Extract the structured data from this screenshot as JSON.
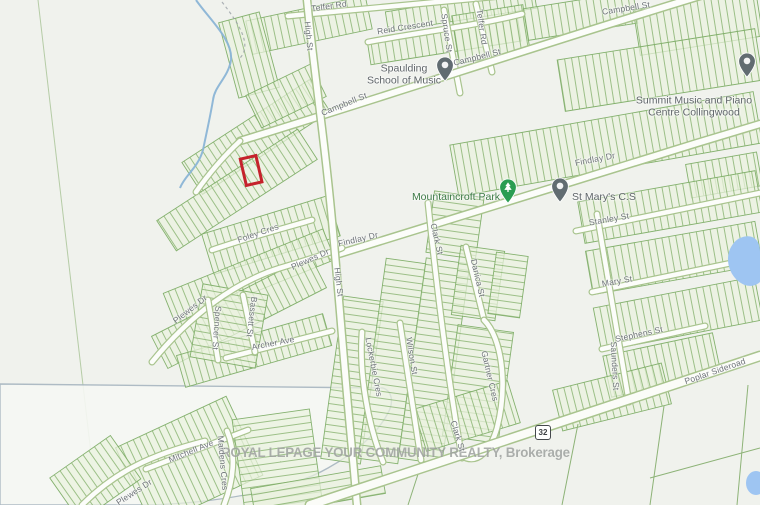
{
  "map": {
    "type": "parcel-map",
    "watermark": "ROYAL LEPAGE YOUR COMMUNITY REALTY, Brokerage",
    "highway_shield": "32",
    "highlight_color": "#c5222c",
    "water_color": "#9ec5f2",
    "parcel_line_color": "#7fae68",
    "street_labels": [
      {
        "text": "Telfer Rd",
        "x": 329,
        "y": 6,
        "rot": -8
      },
      {
        "text": "Reid Crescent",
        "x": 405,
        "y": 27,
        "rot": -9
      },
      {
        "text": "High St",
        "x": 309,
        "y": 36,
        "rot": 84
      },
      {
        "text": "Spruce St",
        "x": 447,
        "y": 33,
        "rot": 82
      },
      {
        "text": "Telfer Rd",
        "x": 482,
        "y": 27,
        "rot": 82
      },
      {
        "text": "Campbell St",
        "x": 477,
        "y": 57,
        "rot": -14
      },
      {
        "text": "Campbell St",
        "x": 626,
        "y": 8,
        "rot": -9
      },
      {
        "text": "Campbell St",
        "x": 344,
        "y": 104,
        "rot": -22
      },
      {
        "text": "Findlay Dr",
        "x": 595,
        "y": 159,
        "rot": -11
      },
      {
        "text": "Findlay Dr",
        "x": 358,
        "y": 239,
        "rot": -13
      },
      {
        "text": "Foley Cres",
        "x": 258,
        "y": 233,
        "rot": -19
      },
      {
        "text": "Plewes Dr",
        "x": 310,
        "y": 259,
        "rot": -24
      },
      {
        "text": "High St",
        "x": 339,
        "y": 282,
        "rot": 83
      },
      {
        "text": "Plewes Dr",
        "x": 190,
        "y": 309,
        "rot": -38
      },
      {
        "text": "Spencer St",
        "x": 217,
        "y": 328,
        "rot": 94
      },
      {
        "text": "Bassett St",
        "x": 252,
        "y": 317,
        "rot": 97
      },
      {
        "text": "Archer Ave",
        "x": 273,
        "y": 343,
        "rot": -11
      },
      {
        "text": "Lockerbie Cres",
        "x": 374,
        "y": 367,
        "rot": 79
      },
      {
        "text": "Wilson St",
        "x": 412,
        "y": 356,
        "rot": 81
      },
      {
        "text": "Clark St",
        "x": 437,
        "y": 239,
        "rot": 77
      },
      {
        "text": "Danica St",
        "x": 478,
        "y": 278,
        "rot": 77
      },
      {
        "text": "Gartner Cres",
        "x": 490,
        "y": 376,
        "rot": 77
      },
      {
        "text": "Clark St",
        "x": 458,
        "y": 436,
        "rot": 73
      },
      {
        "text": "Stanley St",
        "x": 609,
        "y": 219,
        "rot": -10
      },
      {
        "text": "Mary St",
        "x": 617,
        "y": 281,
        "rot": -10
      },
      {
        "text": "Stephens St",
        "x": 639,
        "y": 334,
        "rot": -12
      },
      {
        "text": "Saunders St",
        "x": 615,
        "y": 366,
        "rot": 87
      },
      {
        "text": "Poplar Sideroad",
        "x": 715,
        "y": 371,
        "rot": -19
      },
      {
        "text": "Mitchell Ave",
        "x": 191,
        "y": 451,
        "rot": -22
      },
      {
        "text": "Maidens Cres",
        "x": 223,
        "y": 463,
        "rot": 85
      },
      {
        "text": "Plewes Dr",
        "x": 134,
        "y": 492,
        "rot": -33
      }
    ],
    "pois": [
      {
        "name": "spaulding-school-of-music",
        "lines": [
          "Spaulding",
          "School of Music"
        ],
        "pin": {
          "x": 445,
          "y": 70,
          "color": "#616c71",
          "glyph": "school"
        },
        "label": {
          "x": 404,
          "y": 75,
          "align": "center",
          "color": "#5f6569"
        }
      },
      {
        "name": "summit-music-and-piano-centre-collingwood",
        "lines": [
          "Summit Music and Piano",
          "Centre Collingwood"
        ],
        "pin": {
          "x": 747,
          "y": 66,
          "color": "#616c71",
          "glyph": "school"
        },
        "label": {
          "x": 694,
          "y": 107,
          "align": "center",
          "color": "#5f6569"
        }
      },
      {
        "name": "mountaincroft-park",
        "lines": [
          "Mountaincroft Park"
        ],
        "pin": {
          "x": 508,
          "y": 192,
          "color": "#2a9d52",
          "glyph": "tree"
        },
        "label": {
          "x": 456,
          "y": 197,
          "align": "center",
          "color": "#3d7a46"
        }
      },
      {
        "name": "st-marys-cs",
        "lines": [
          "St Mary's C.S"
        ],
        "pin": {
          "x": 560,
          "y": 191,
          "color": "#616c71",
          "glyph": "school"
        },
        "label": {
          "x": 572,
          "y": 197,
          "align": "left",
          "color": "#5f6569"
        }
      }
    ]
  }
}
